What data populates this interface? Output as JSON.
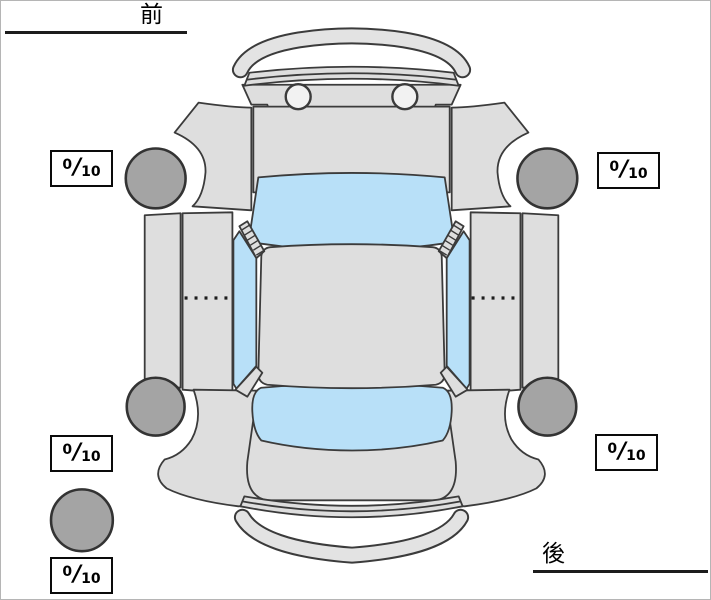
{
  "page": {
    "front_label": "前",
    "rear_label": "後"
  },
  "scores": {
    "front_left": {
      "position": "front-left",
      "value": "0",
      "slash": "/",
      "max": "10"
    },
    "front_right": {
      "position": "front-right",
      "value": "0",
      "slash": "/",
      "max": "10"
    },
    "rear_left": {
      "position": "rear-left",
      "value": "0",
      "slash": "/",
      "max": "10"
    },
    "rear_right": {
      "position": "rear-right",
      "value": "0",
      "slash": "/",
      "max": "10"
    },
    "spare": {
      "position": "spare",
      "value": "0",
      "slash": "/",
      "max": "10"
    }
  },
  "diagram": {
    "type": "car-top-view",
    "orientation": {
      "front_side": "top",
      "rear_side": "bottom"
    },
    "colors": {
      "body": "#dedede",
      "windows": "#b8e0f8",
      "tires": "#a4a4a4",
      "outline": "#3b3b3b",
      "headlight": "#f2f2f2"
    },
    "tires": [
      "front-left",
      "front-right",
      "rear-left",
      "rear-right",
      "spare"
    ]
  }
}
